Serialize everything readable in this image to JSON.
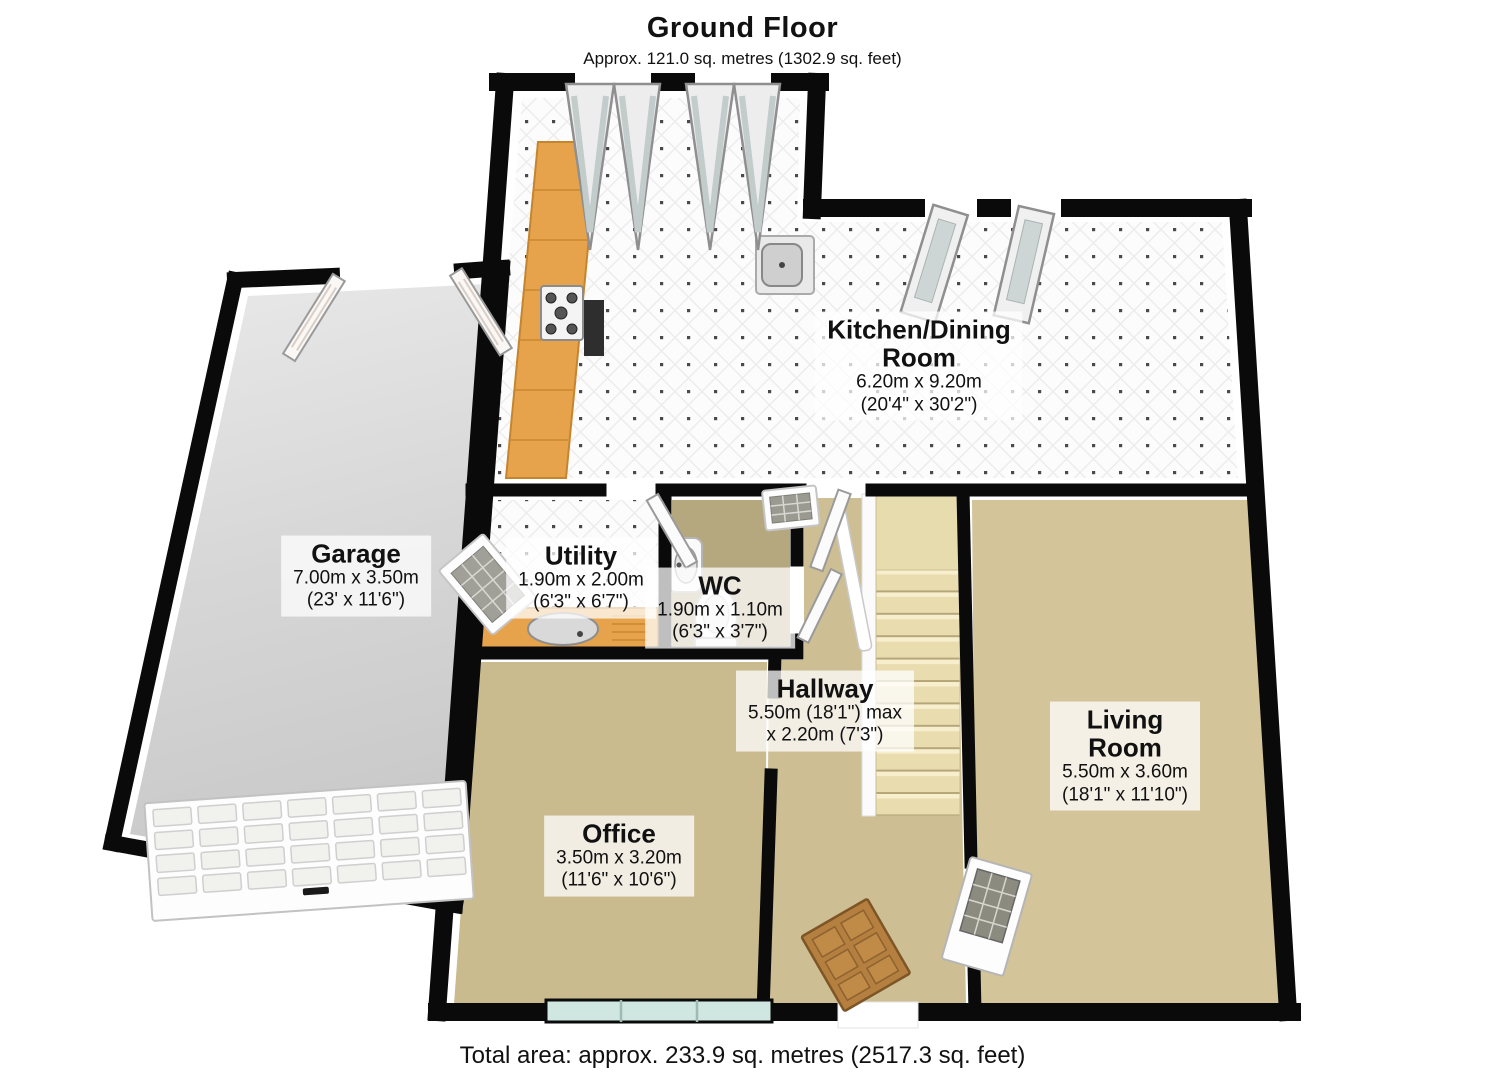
{
  "header": {
    "title": "Ground Floor",
    "subtitle": "Approx. 121.0 sq. metres (1302.9 sq. feet)"
  },
  "footer": {
    "total_area": "Total area: approx. 233.9 sq. metres (2517.3 sq. feet)"
  },
  "rooms": {
    "kitchen": {
      "line1": "Kitchen/Dining",
      "line2": "Room",
      "metric": "6.20m x 9.20m",
      "imperial": "(20'4\" x 30'2\")"
    },
    "garage": {
      "line1": "Garage",
      "metric": "7.00m x 3.50m",
      "imperial": "(23' x 11'6\")"
    },
    "utility": {
      "line1": "Utility",
      "metric": "1.90m x 2.00m",
      "imperial": "(6'3\" x 6'7\")"
    },
    "wc": {
      "line1": "WC",
      "metric": "1.90m x 1.10m",
      "imperial": "(6'3\" x 3'7\")"
    },
    "hallway": {
      "line1": "Hallway",
      "metric": "5.50m (18'1\") max",
      "imperial": "x 2.20m (7'3\")"
    },
    "office": {
      "line1": "Office",
      "metric": "3.50m x 3.20m",
      "imperial": "(11'6\" x 10'6\")"
    },
    "living": {
      "line1": "Living",
      "line2": "Room",
      "metric": "5.50m x 3.60m",
      "imperial": "(18'1\" x 11'10\")"
    }
  },
  "palette": {
    "wall": "#0a0a0a",
    "carpet": "#cfc196",
    "tile_floor": "#fcfcfc",
    "garage_floor": "#d7d7d7",
    "counter_wood": "#e6a34b",
    "stairs": "#e9ddb0",
    "window_glass": "#cfe6e1",
    "door_wood": "#b5803f"
  }
}
